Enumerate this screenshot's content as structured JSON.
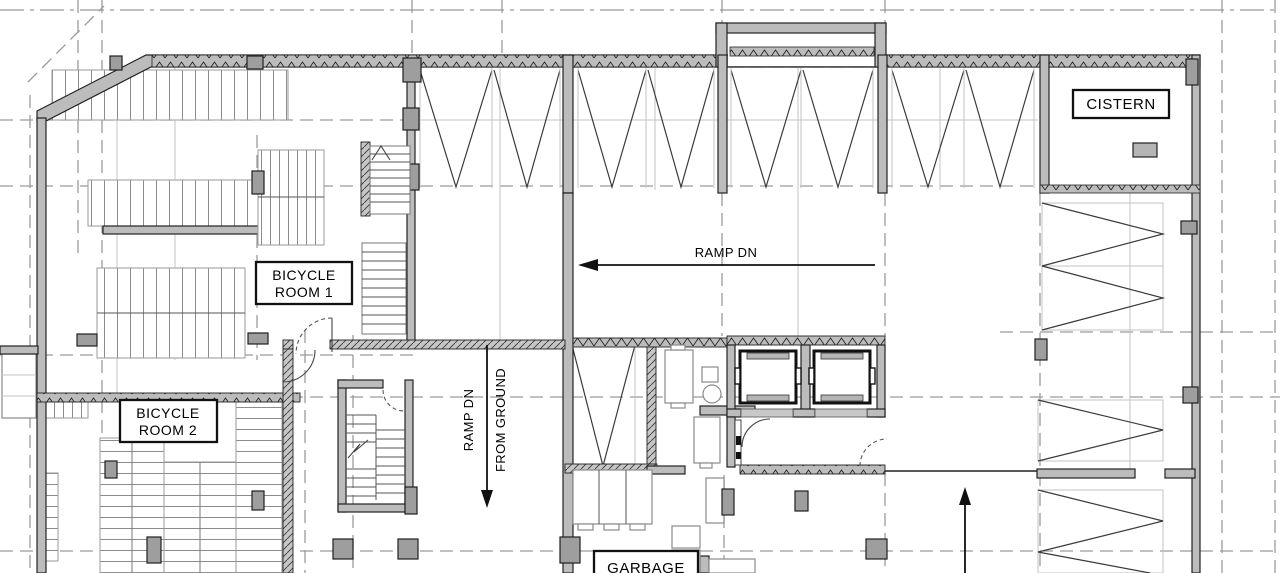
{
  "plan": {
    "type": "architectural-floor-plan",
    "rooms": {
      "cistern": {
        "label": "CISTERN"
      },
      "bicycle_room_1": {
        "line1": "BICYCLE",
        "line2": "ROOM 1"
      },
      "bicycle_room_2": {
        "line1": "BICYCLE",
        "line2": "ROOM 2"
      },
      "garbage": {
        "label": "GARBAGE"
      }
    },
    "annotations": {
      "ramp_dn_horizontal": {
        "label": "RAMP DN",
        "arrow_direction": "left"
      },
      "ramp_dn_vertical": {
        "line1": "RAMP DN",
        "line2": "FROM GROUND",
        "arrow_direction": "down"
      },
      "exit_arrow": {
        "arrow_direction": "up"
      }
    },
    "colors": {
      "background": "#ffffff",
      "wall_fill": "#bcbcbc",
      "column_fill": "#9e9e9e",
      "line": "#1f1f1f",
      "grid_line": "#9b9b9b",
      "light_line": "#c3c3c3"
    }
  }
}
